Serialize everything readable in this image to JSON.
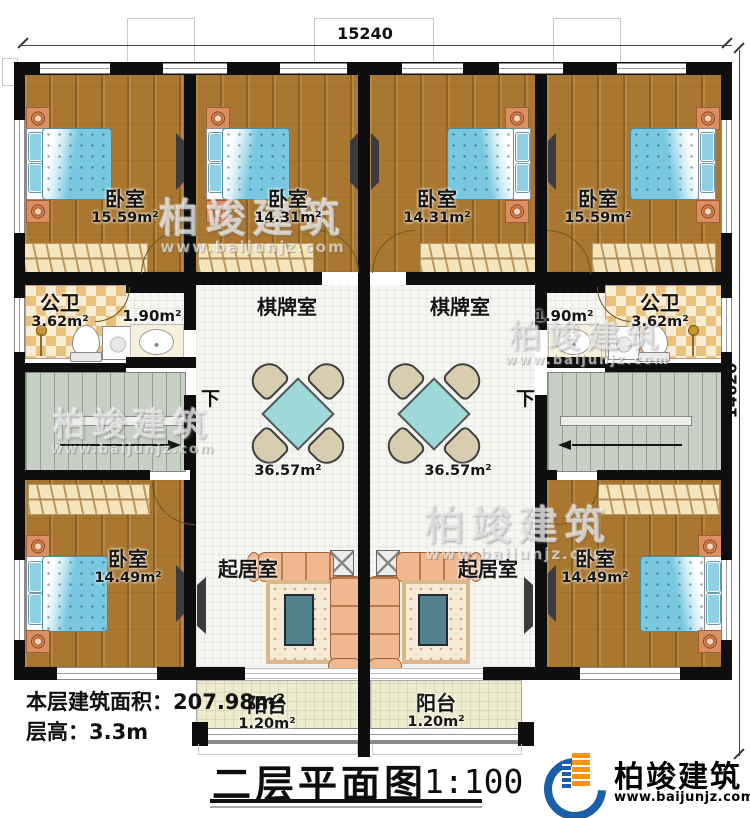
{
  "dimensions": {
    "top": "15240",
    "right": "14620"
  },
  "rooms": {
    "bed_tl": {
      "name": "卧室",
      "area": "15.59m²"
    },
    "bed_tml": {
      "name": "卧室",
      "area": "14.31m²"
    },
    "bed_tmr": {
      "name": "卧室",
      "area": "14.31m²"
    },
    "bed_tr": {
      "name": "卧室",
      "area": "15.59m²"
    },
    "bath_l": {
      "name": "公卫",
      "area": "3.62m²"
    },
    "bath_r": {
      "name": "公卫",
      "area": "3.62m²"
    },
    "wash_l": {
      "area": "1.90m²"
    },
    "wash_r": {
      "area": "1.90m²"
    },
    "chess_l": {
      "name": "棋牌室",
      "area": "36.57m²"
    },
    "chess_r": {
      "name": "棋牌室",
      "area": "36.57m²"
    },
    "living_l": {
      "name": "起居室"
    },
    "living_r": {
      "name": "起居室"
    },
    "bed_bl": {
      "name": "卧室",
      "area": "14.49m²"
    },
    "bed_br": {
      "name": "卧室",
      "area": "14.49m²"
    },
    "balcony_l": {
      "name": "阳台",
      "area": "1.20m²"
    },
    "balcony_r": {
      "name": "阳台",
      "area": "1.20m²"
    }
  },
  "stairs": {
    "down_l": "下",
    "down_r": "下"
  },
  "notes": {
    "floor_area": "本层建筑面积：207.98m²",
    "floor_height": "层高：3.3m"
  },
  "title": {
    "text": "二层平面图",
    "scale": "1:100"
  },
  "brand": {
    "name": "柏竣建筑",
    "url": "www.baijunjz.com"
  },
  "watermark": {
    "text": "柏竣建筑",
    "url": "www.baijunjz.com"
  },
  "colors": {
    "wall": "#0e0e0e",
    "wood_floor": "#a9772f",
    "tile": "#eac17c",
    "bed": "#79c8e0",
    "table": "#9ed9d9",
    "sofa": "#f0b88e",
    "brand_blue": "#1a5fa8",
    "brand_orange": "#f6930f"
  }
}
